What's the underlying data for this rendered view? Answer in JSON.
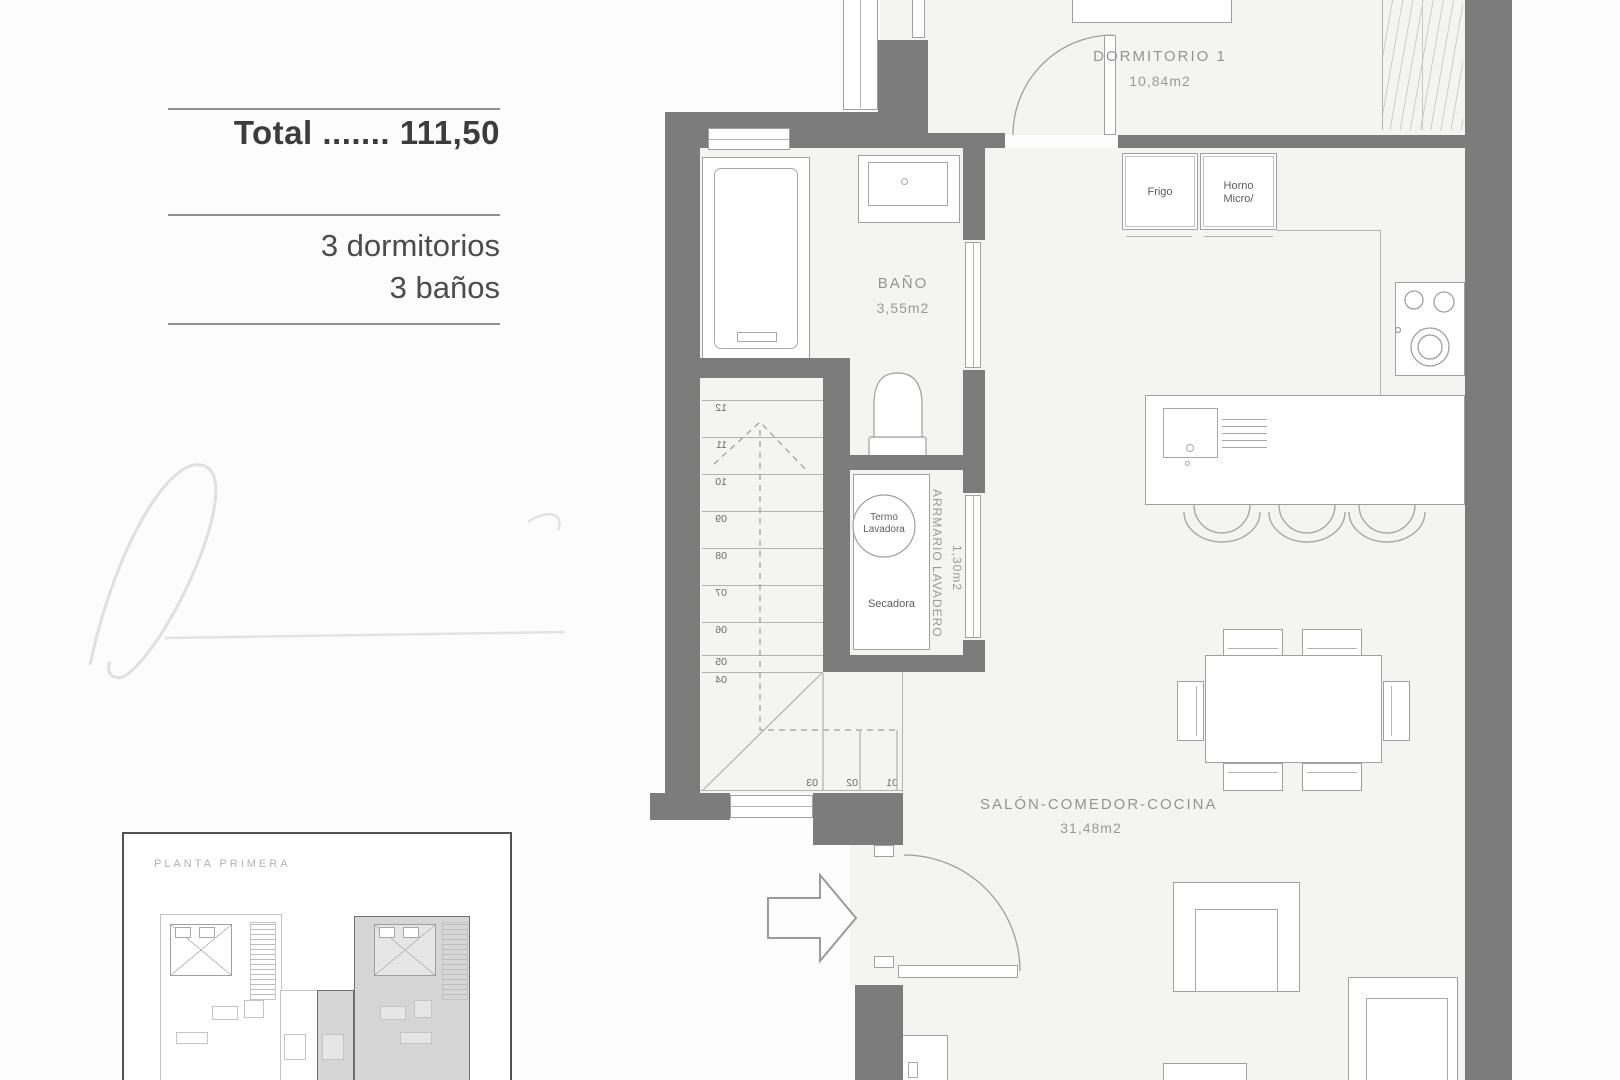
{
  "summary": {
    "total": "Total ....... 111,50",
    "features": [
      "3 dormitorios",
      "3 baños"
    ]
  },
  "plan": {
    "rooms": {
      "dormitorio1": {
        "name": "DORMITORIO 1",
        "area": "10,84m2"
      },
      "bano": {
        "name": "BAÑO",
        "area": "3,55m2"
      },
      "salon": {
        "name": "SALÓN-COMEDOR-COCINA",
        "area": "31,48m2"
      },
      "lavadero": {
        "name": "ARRMARIO LAVADERO",
        "area": "1,30m2"
      }
    },
    "appliances": {
      "frigo": "Frigo",
      "horno_l1": "Horno",
      "horno_l2": "Micro/",
      "termo_l1": "Termo",
      "termo_l2": "Lavadora",
      "secadora": "Secadora"
    },
    "stairs": {
      "run": [
        "12",
        "11",
        "10",
        "09",
        "08",
        "07",
        "06",
        "05",
        "04"
      ],
      "turn": [
        "03",
        "02",
        "01"
      ]
    }
  },
  "thumbnail": {
    "label": "PLANTA PRIMERA"
  },
  "colors": {
    "wall": "#7c7c7c",
    "floor": "#f4f4f3",
    "line": "#a0a0a0",
    "label_text": "#949494",
    "dark_text": "#3c3c3c"
  }
}
